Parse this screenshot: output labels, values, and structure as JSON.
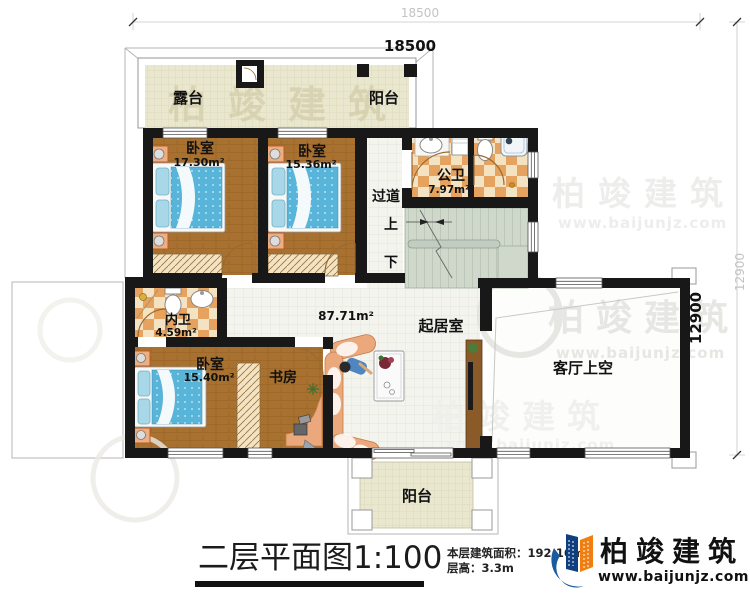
{
  "dimensions": {
    "width_outer": "18500",
    "width_inner": "18500",
    "height_outer": "12900",
    "height_inner": "12900"
  },
  "rooms": {
    "terrace": {
      "name": "露台"
    },
    "balcony_top": {
      "name": "阳台"
    },
    "bedroom_1": {
      "name": "卧室",
      "area": "17.30m²"
    },
    "bedroom_2": {
      "name": "卧室",
      "area": "15.36m²"
    },
    "public_bathroom": {
      "name": "公卫",
      "area": "7.97m²"
    },
    "hallway": {
      "name": "过道"
    },
    "stairs": {
      "up": "上",
      "down": "下"
    },
    "private_bathroom": {
      "name": "内卫",
      "area": "4.59m²"
    },
    "bedroom_3": {
      "name": "卧室",
      "area": "15.40m²"
    },
    "study": {
      "name": "书房"
    },
    "living_room": {
      "name": "起居室",
      "area": "87.71m²"
    },
    "void": {
      "name": "客厅上空"
    },
    "balcony_bottom": {
      "name": "阳台"
    }
  },
  "title_block": {
    "title": "二层平面图1:100",
    "floor_area": "本层建筑面积：192.16m²",
    "floor_height": "层高：3.3m"
  },
  "brand": {
    "name": "柏竣建筑",
    "website": "www.baijunjz.com"
  },
  "colors": {
    "wall": "#1a1a1a",
    "wood_floor": "#a9712f",
    "tile_beige": "#eae7cf",
    "bath_tile_orange": "#e5a35f",
    "mattress_blue": "#58b4d8",
    "stair_green": "#cfd8cb",
    "logo_blue": "#1a5a9e",
    "logo_orange": "#ef7f10"
  }
}
